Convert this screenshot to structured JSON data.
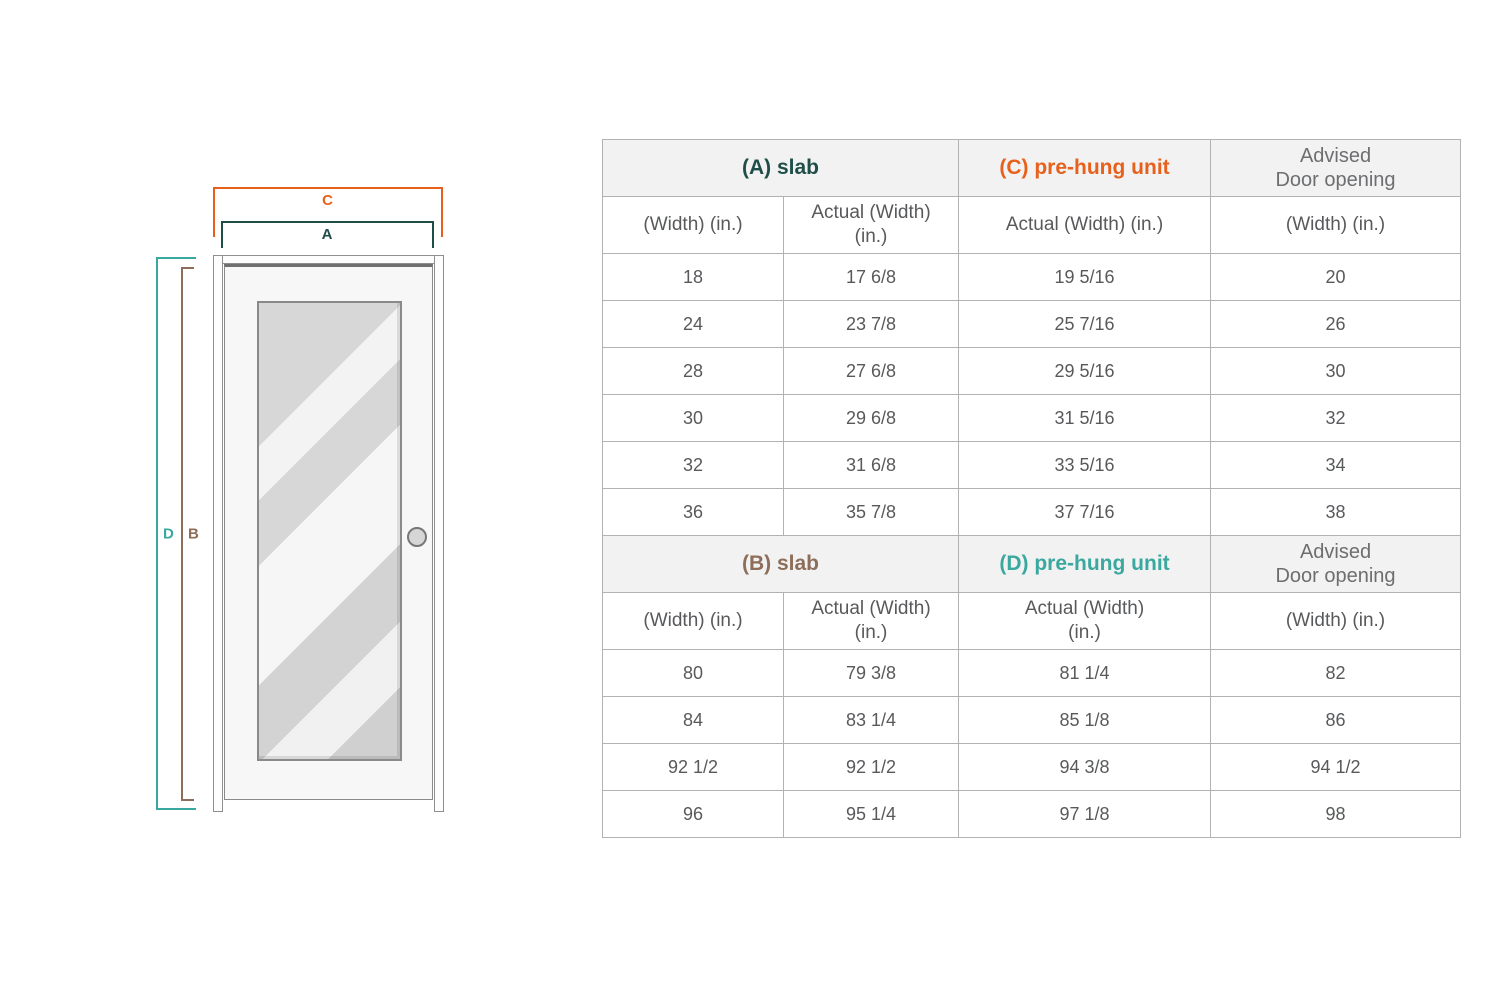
{
  "colors": {
    "accent_orange": "#e8611c",
    "accent_dark_green": "#1f4e49",
    "accent_teal": "#3aa89e",
    "accent_brown": "#8d6e5a",
    "table_border": "#b2b2b2",
    "header_bg": "#f2f2f2",
    "text_gray": "#58595b",
    "text_gray_light": "#6d6e70"
  },
  "diagram": {
    "labels": {
      "c": "C",
      "a": "A",
      "d": "D",
      "b": "B"
    }
  },
  "table": {
    "sections": [
      {
        "group_headers": [
          {
            "label": "(A) slab",
            "color": "#1f4e49",
            "advised": false
          },
          {
            "label": "(C) pre-hung unit",
            "color": "#e8611c",
            "advised": false
          },
          {
            "label": "Advised\nDoor opening",
            "color": "#6d6e70",
            "advised": true
          }
        ],
        "col_headers": [
          "(Width) (in.)",
          "Actual (Width)\n(in.)",
          "Actual (Width) (in.)",
          "(Width) (in.)"
        ],
        "rows": [
          [
            "18",
            "17 6/8",
            "19 5/16",
            "20"
          ],
          [
            "24",
            "23 7/8",
            "25 7/16",
            "26"
          ],
          [
            "28",
            "27 6/8",
            "29 5/16",
            "30"
          ],
          [
            "30",
            "29 6/8",
            "31 5/16",
            "32"
          ],
          [
            "32",
            "31 6/8",
            "33 5/16",
            "34"
          ],
          [
            "36",
            "35 7/8",
            "37 7/16",
            "38"
          ]
        ]
      },
      {
        "group_headers": [
          {
            "label": "(B) slab",
            "color": "#8d6e5a",
            "advised": false
          },
          {
            "label": "(D) pre-hung unit",
            "color": "#3aa89e",
            "advised": false
          },
          {
            "label": "Advised\nDoor opening",
            "color": "#6d6e70",
            "advised": true
          }
        ],
        "col_headers": [
          "(Width) (in.)",
          "Actual (Width)\n(in.)",
          "Actual (Width)\n(in.)",
          "(Width) (in.)"
        ],
        "rows": [
          [
            "80",
            "79 3/8",
            "81 1/4",
            "82"
          ],
          [
            "84",
            "83 1/4",
            "85 1/8",
            "86"
          ],
          [
            "92 1/2",
            "92 1/2",
            "94 3/8",
            "94 1/2"
          ],
          [
            "96",
            "95 1/4",
            "97 1/8",
            "98"
          ]
        ]
      }
    ]
  }
}
